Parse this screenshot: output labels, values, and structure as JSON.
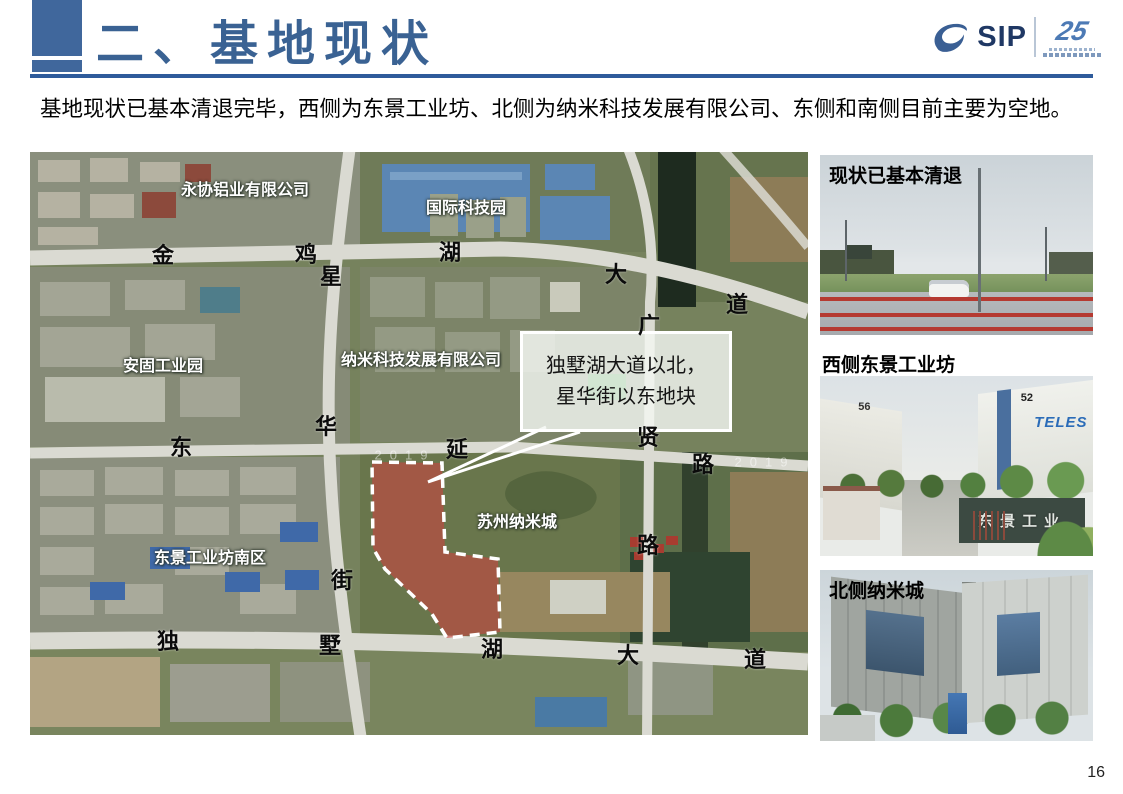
{
  "slide": {
    "title": "二、基地现状",
    "intro": "基地现状已基本清退完毕，西侧为东景工业坊、北侧为纳米科技发展有限公司、东侧和南侧目前主要为空地。",
    "page_number": "16"
  },
  "logo": {
    "name": "SIP",
    "anniversary": "25"
  },
  "map": {
    "callout": {
      "line1": "独墅湖大道以北，",
      "line2": "星华街以东地块"
    },
    "site_color": "#cc4440",
    "watermark_text": "2019",
    "watermarks": [
      {
        "x": 375,
        "y": 303
      },
      {
        "x": 735,
        "y": 310
      }
    ],
    "area_labels": [
      {
        "text": "永协铝业有限公司",
        "x": 215,
        "y": 36
      },
      {
        "text": "国际科技园",
        "x": 436,
        "y": 54
      },
      {
        "text": "安固工业园",
        "x": 133,
        "y": 212
      },
      {
        "text": "纳米科技发展有限公司",
        "x": 391,
        "y": 206
      },
      {
        "text": "苏州纳米城",
        "x": 487,
        "y": 368
      },
      {
        "text": "东景工业坊南区",
        "x": 180,
        "y": 404
      }
    ],
    "road_labels": [
      {
        "text": "金",
        "x": 133,
        "y": 102
      },
      {
        "text": "鸡",
        "x": 276,
        "y": 101
      },
      {
        "text": "湖",
        "x": 420,
        "y": 99
      },
      {
        "text": "大",
        "x": 586,
        "y": 121
      },
      {
        "text": "道",
        "x": 707,
        "y": 151
      },
      {
        "text": "星",
        "x": 301,
        "y": 123
      },
      {
        "text": "华",
        "x": 296,
        "y": 273
      },
      {
        "text": "街",
        "x": 312,
        "y": 427
      },
      {
        "text": "东",
        "x": 151,
        "y": 294
      },
      {
        "text": "延",
        "x": 427,
        "y": 296
      },
      {
        "text": "路",
        "x": 673,
        "y": 311
      },
      {
        "text": "广",
        "x": 619,
        "y": 172
      },
      {
        "text": "贤",
        "x": 618,
        "y": 284
      },
      {
        "text": "路",
        "x": 618,
        "y": 392
      },
      {
        "text": "独",
        "x": 138,
        "y": 488
      },
      {
        "text": "墅",
        "x": 300,
        "y": 492
      },
      {
        "text": "湖",
        "x": 462,
        "y": 496
      },
      {
        "text": "大",
        "x": 598,
        "y": 502
      },
      {
        "text": "道",
        "x": 725,
        "y": 506
      }
    ]
  },
  "photos": [
    {
      "caption": "现状已基本清退"
    },
    {
      "caption": "西侧东景工业坊",
      "building_left": "56",
      "building_right": "52",
      "sign": "TELES",
      "gate_sign": "东景工业"
    },
    {
      "caption": "北侧纳米城"
    }
  ]
}
